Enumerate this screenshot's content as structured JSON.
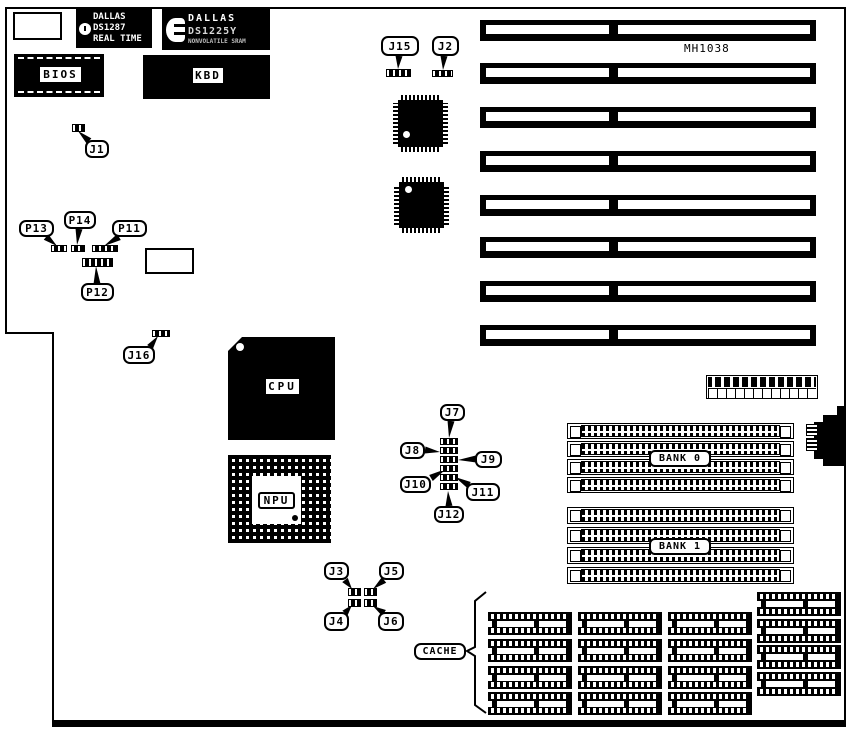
{
  "board": {
    "chipset_label": "MH1038",
    "bios_label": "BIOS",
    "kbd_label": "KBD",
    "cpu_label": "CPU",
    "npu_label": "NPU",
    "cache_label": "CACHE",
    "rtc_chip": {
      "brand": "DALLAS",
      "part": "DS1287",
      "subtitle": "REAL TIME"
    },
    "nvram_chip": {
      "brand": "DALLAS",
      "part": "DS1225Y",
      "subtitle": "NONVOLATILE SRAM"
    }
  },
  "isa": {
    "x": 480,
    "w": 336,
    "h": 21,
    "slot_ys": [
      20,
      63,
      107,
      151,
      195,
      237,
      281,
      325
    ]
  },
  "memory": {
    "simm_x": 567,
    "simm_w": 227,
    "banks": [
      {
        "label": "BANK 0",
        "row_h": 16,
        "rows_y": [
          423,
          441,
          459,
          477
        ],
        "label_box": [
          649,
          450,
          62,
          17
        ]
      },
      {
        "label": "BANK 1",
        "row_h": 17,
        "rows_y": [
          507,
          527,
          547,
          567
        ],
        "label_box": [
          649,
          538,
          62,
          17
        ]
      }
    ]
  },
  "cache_grid": {
    "w": 84,
    "h": 23,
    "cols_x": [
      488,
      578,
      668
    ],
    "rows_y": [
      612,
      639,
      666,
      692
    ],
    "right_col": {
      "x": 757,
      "w": 84,
      "h": 24,
      "rows_y": [
        592,
        619,
        645,
        672
      ]
    }
  },
  "qfp_chips": [
    {
      "x": 393,
      "y": 95,
      "w": 55,
      "h": 57,
      "dot": [
        10,
        36
      ]
    },
    {
      "x": 394,
      "y": 177,
      "w": 55,
      "h": 56,
      "dot": [
        11,
        9
      ]
    }
  ],
  "callouts": [
    {
      "label": "J15",
      "x": 381,
      "y": 36,
      "w": 38,
      "h": 20,
      "tail": [
        399,
        56,
        398,
        69
      ]
    },
    {
      "label": "J2",
      "x": 432,
      "y": 36,
      "w": 27,
      "h": 20,
      "tail": [
        444,
        56,
        443,
        70
      ]
    },
    {
      "label": "J1",
      "x": 85,
      "y": 140,
      "w": 24,
      "h": 18,
      "tail": [
        89,
        141,
        78,
        131
      ]
    },
    {
      "label": "P13",
      "x": 19,
      "y": 220,
      "w": 35,
      "h": 17,
      "tail": [
        46,
        237,
        57,
        246
      ]
    },
    {
      "label": "P14",
      "x": 64,
      "y": 211,
      "w": 32,
      "h": 18,
      "tail": [
        79,
        229,
        77,
        245
      ]
    },
    {
      "label": "P11",
      "x": 112,
      "y": 220,
      "w": 35,
      "h": 17,
      "tail": [
        119,
        237,
        104,
        246
      ]
    },
    {
      "label": "P12",
      "x": 81,
      "y": 283,
      "w": 33,
      "h": 18,
      "tail": [
        97,
        284,
        96,
        266
      ]
    },
    {
      "label": "J16",
      "x": 123,
      "y": 346,
      "w": 32,
      "h": 18,
      "tail": [
        150,
        347,
        158,
        336
      ]
    },
    {
      "label": "J7",
      "x": 440,
      "y": 404,
      "w": 25,
      "h": 17,
      "tail": [
        451,
        421,
        449,
        438
      ]
    },
    {
      "label": "J8",
      "x": 400,
      "y": 442,
      "w": 25,
      "h": 17,
      "tail": [
        425,
        450,
        440,
        452
      ]
    },
    {
      "label": "J9",
      "x": 475,
      "y": 451,
      "w": 27,
      "h": 17,
      "tail": [
        476,
        459,
        458,
        460
      ]
    },
    {
      "label": "J10",
      "x": 400,
      "y": 476,
      "w": 31,
      "h": 17,
      "tail": [
        431,
        478,
        446,
        469
      ]
    },
    {
      "label": "J11",
      "x": 466,
      "y": 483,
      "w": 34,
      "h": 18,
      "tail": [
        469,
        485,
        455,
        477
      ]
    },
    {
      "label": "J12",
      "x": 434,
      "y": 506,
      "w": 30,
      "h": 17,
      "tail": [
        449,
        506,
        448,
        491
      ]
    },
    {
      "label": "J3",
      "x": 324,
      "y": 562,
      "w": 25,
      "h": 18,
      "tail": [
        345,
        580,
        352,
        589
      ]
    },
    {
      "label": "J5",
      "x": 379,
      "y": 562,
      "w": 25,
      "h": 18,
      "tail": [
        384,
        580,
        373,
        589
      ]
    },
    {
      "label": "J4",
      "x": 324,
      "y": 612,
      "w": 25,
      "h": 19,
      "tail": [
        345,
        613,
        352,
        605
      ]
    },
    {
      "label": "J6",
      "x": 378,
      "y": 612,
      "w": 26,
      "h": 19,
      "tail": [
        384,
        613,
        373,
        606
      ]
    }
  ],
  "jumpers": [
    [
      386,
      69,
      25,
      8
    ],
    [
      432,
      70,
      21,
      7
    ],
    [
      72,
      124,
      13,
      8
    ],
    [
      51,
      245,
      16,
      7
    ],
    [
      71,
      245,
      14,
      7
    ],
    [
      92,
      245,
      26,
      7
    ],
    [
      82,
      258,
      31,
      9
    ],
    [
      152,
      330,
      18,
      7
    ],
    [
      440,
      438,
      18,
      7
    ],
    [
      440,
      447,
      18,
      7
    ],
    [
      440,
      456,
      18,
      7
    ],
    [
      440,
      465,
      18,
      7
    ],
    [
      440,
      474,
      18,
      7
    ],
    [
      440,
      483,
      18,
      7
    ],
    [
      348,
      588,
      13,
      8
    ],
    [
      364,
      588,
      13,
      8
    ],
    [
      348,
      599,
      13,
      8
    ],
    [
      364,
      599,
      13,
      8
    ]
  ],
  "sockets": [
    [
      13,
      12,
      49,
      28
    ],
    [
      145,
      248,
      49,
      26
    ]
  ]
}
